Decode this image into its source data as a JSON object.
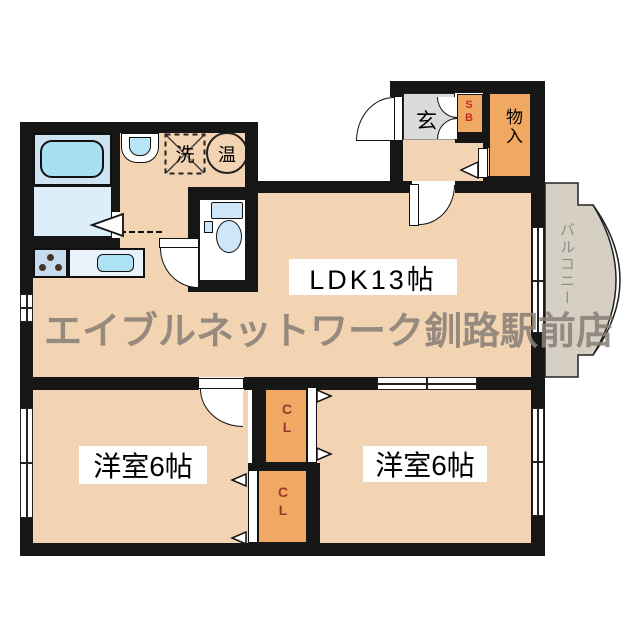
{
  "plan": {
    "watermark": "エイブルネットワーク釧路駅前店",
    "rooms": {
      "ldk": "LDK13帖",
      "bedroom_left": "洋室6帖",
      "bedroom_right": "洋室6帖",
      "balcony": "バルコニー",
      "entrance": "玄",
      "shoe_box": "SB",
      "storage": "物入",
      "closet": "CL",
      "washer": "洗",
      "water_heater": "温"
    },
    "colors": {
      "wall": "#161616",
      "floor": "#f2d3b2",
      "storage_orange": "#efa963",
      "entrance_gray": "#dbdbd9",
      "balcony_gray": "#d6cfc3",
      "bath_unit_blue": "#cfe4f2",
      "tub_blue": "#a9dff2",
      "bath_floor_blue": "#dceefa",
      "fixture_blue": "#cfe6f8",
      "closet_label_red": "#9b372c",
      "shoebox_label_red": "#cc2a2a",
      "watermark_gray": "#8a8077"
    }
  }
}
